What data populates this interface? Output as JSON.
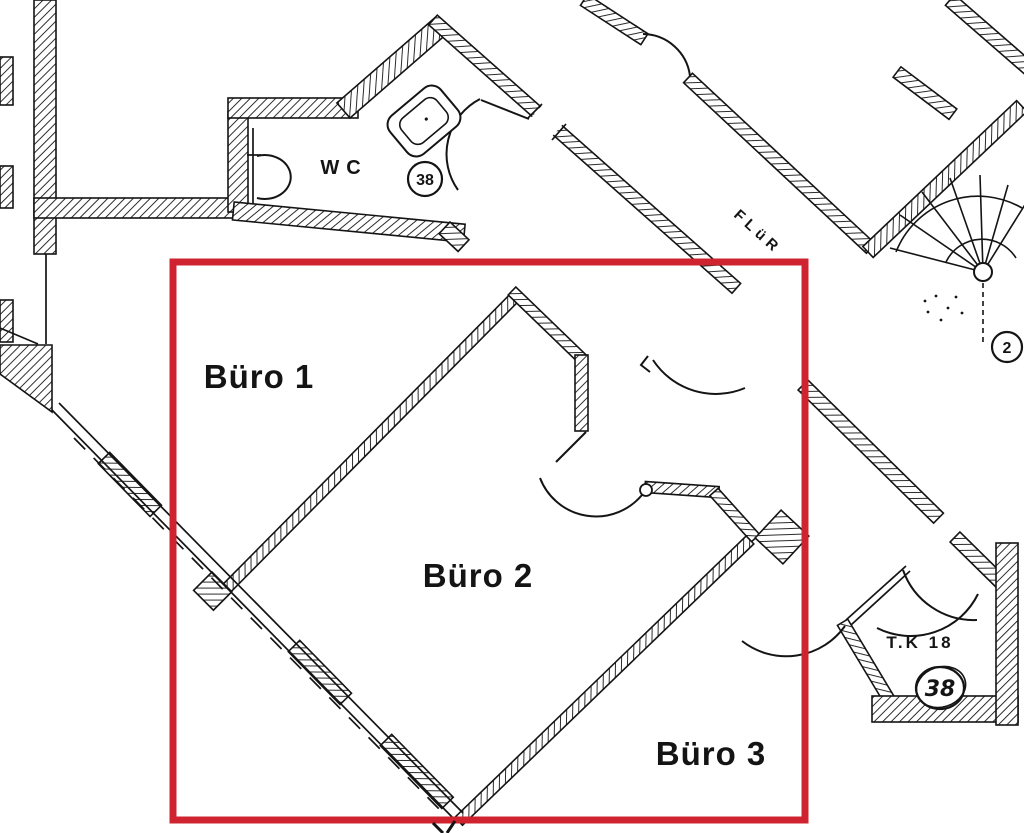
{
  "annotation": {
    "highlight_color": "#cf2430"
  },
  "drawing": {
    "ink_color": "#141414",
    "paper_color": "#ffffff"
  },
  "rooms": {
    "buero1": {
      "label": "Büro 1"
    },
    "buero2": {
      "label": "Büro 2"
    },
    "buero3": {
      "label": "Büro 3"
    },
    "wc": {
      "label": "WC",
      "door_badge": "38"
    },
    "corridor": {
      "label": "FLüR"
    },
    "tk": {
      "label": "T.K 18",
      "door_badge": "38"
    },
    "staircase": {
      "badge": "2"
    }
  }
}
